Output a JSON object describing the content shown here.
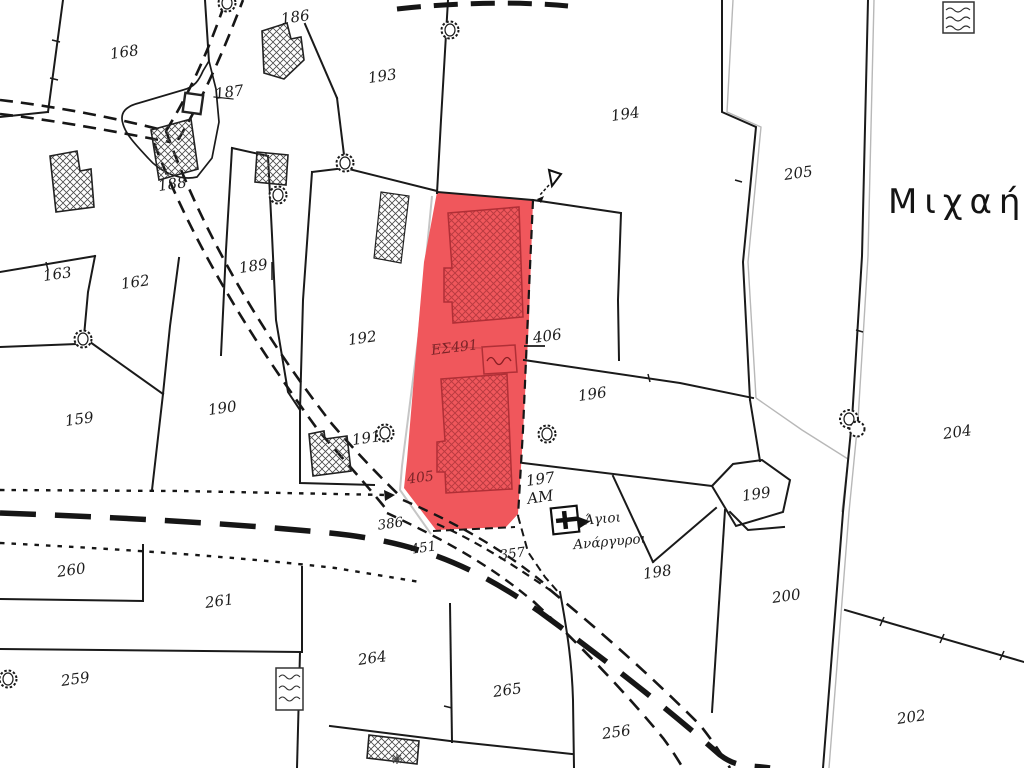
{
  "map": {
    "region_name": "Μιχαήλη",
    "highlighted_parcel": {
      "number": "405",
      "code": "ΕΣ491"
    },
    "church_name": "Άγιοι Ανάργυροι",
    "colors": {
      "highlight_fill": "#f0575c",
      "highlight_hatch": "#bb3b41",
      "highlight_text": "#7d2428",
      "boundary_line": "#1a1a1a",
      "old_boundary_gray": "#b8b8b8"
    },
    "labels": [
      {
        "text": "168",
        "x": 125,
        "y": 57,
        "cls": "parcel"
      },
      {
        "text": "186",
        "x": 296,
        "y": 22,
        "cls": "parcel"
      },
      {
        "text": "187",
        "x": 230,
        "y": 97,
        "cls": "parcel"
      },
      {
        "text": "188",
        "x": 173,
        "y": 189,
        "cls": "parcel"
      },
      {
        "text": "189",
        "x": 254,
        "y": 271,
        "cls": "parcel"
      },
      {
        "text": "193",
        "x": 383,
        "y": 81,
        "cls": "parcel"
      },
      {
        "text": "194",
        "x": 626,
        "y": 119,
        "cls": "parcel"
      },
      {
        "text": "205",
        "x": 799,
        "y": 178,
        "cls": "parcel"
      },
      {
        "text": "163",
        "x": 58,
        "y": 279,
        "cls": "parcel"
      },
      {
        "text": "162",
        "x": 136,
        "y": 287,
        "cls": "parcel"
      },
      {
        "text": "159",
        "x": 80,
        "y": 424,
        "cls": "parcel"
      },
      {
        "text": "190",
        "x": 223,
        "y": 413,
        "cls": "parcel"
      },
      {
        "text": "192",
        "x": 363,
        "y": 343,
        "cls": "parcel"
      },
      {
        "text": "191",
        "x": 367,
        "y": 443,
        "cls": "parcel"
      },
      {
        "text": "406",
        "x": 548,
        "y": 341,
        "cls": "parcel"
      },
      {
        "text": "196",
        "x": 593,
        "y": 399,
        "cls": "parcel"
      },
      {
        "text": "197",
        "x": 541,
        "y": 484,
        "cls": "parcel"
      },
      {
        "text": "AM",
        "x": 541,
        "y": 502,
        "cls": "parcel"
      },
      {
        "text": "199",
        "x": 757,
        "y": 499,
        "cls": "parcel"
      },
      {
        "text": "198",
        "x": 658,
        "y": 577,
        "cls": "parcel"
      },
      {
        "text": "200",
        "x": 787,
        "y": 601,
        "cls": "parcel"
      },
      {
        "text": "204",
        "x": 958,
        "y": 437,
        "cls": "parcel"
      },
      {
        "text": "202",
        "x": 912,
        "y": 722,
        "cls": "parcel"
      },
      {
        "text": "260",
        "x": 72,
        "y": 575,
        "cls": "parcel"
      },
      {
        "text": "261",
        "x": 220,
        "y": 606,
        "cls": "parcel"
      },
      {
        "text": "259",
        "x": 76,
        "y": 684,
        "cls": "parcel"
      },
      {
        "text": "264",
        "x": 373,
        "y": 663,
        "cls": "parcel"
      },
      {
        "text": "265",
        "x": 508,
        "y": 695,
        "cls": "parcel"
      },
      {
        "text": "256",
        "x": 617,
        "y": 737,
        "cls": "parcel"
      },
      {
        "text": "386",
        "x": 391,
        "y": 528,
        "cls": "road"
      },
      {
        "text": "451",
        "x": 424,
        "y": 552,
        "cls": "road"
      },
      {
        "text": "357",
        "x": 513,
        "y": 558,
        "cls": "road"
      },
      {
        "text": "405",
        "x": 421,
        "y": 482,
        "cls": "red"
      },
      {
        "text": "ΕΣ491",
        "x": 455,
        "y": 352,
        "cls": "red"
      },
      {
        "text": "Άγιοι",
        "x": 603,
        "y": 523,
        "cls": "church"
      },
      {
        "text": "Ανάργυροι",
        "x": 610,
        "y": 546,
        "cls": "church"
      },
      {
        "text": "Μιχαήλη",
        "x": 888,
        "y": 213,
        "cls": "region"
      }
    ]
  }
}
